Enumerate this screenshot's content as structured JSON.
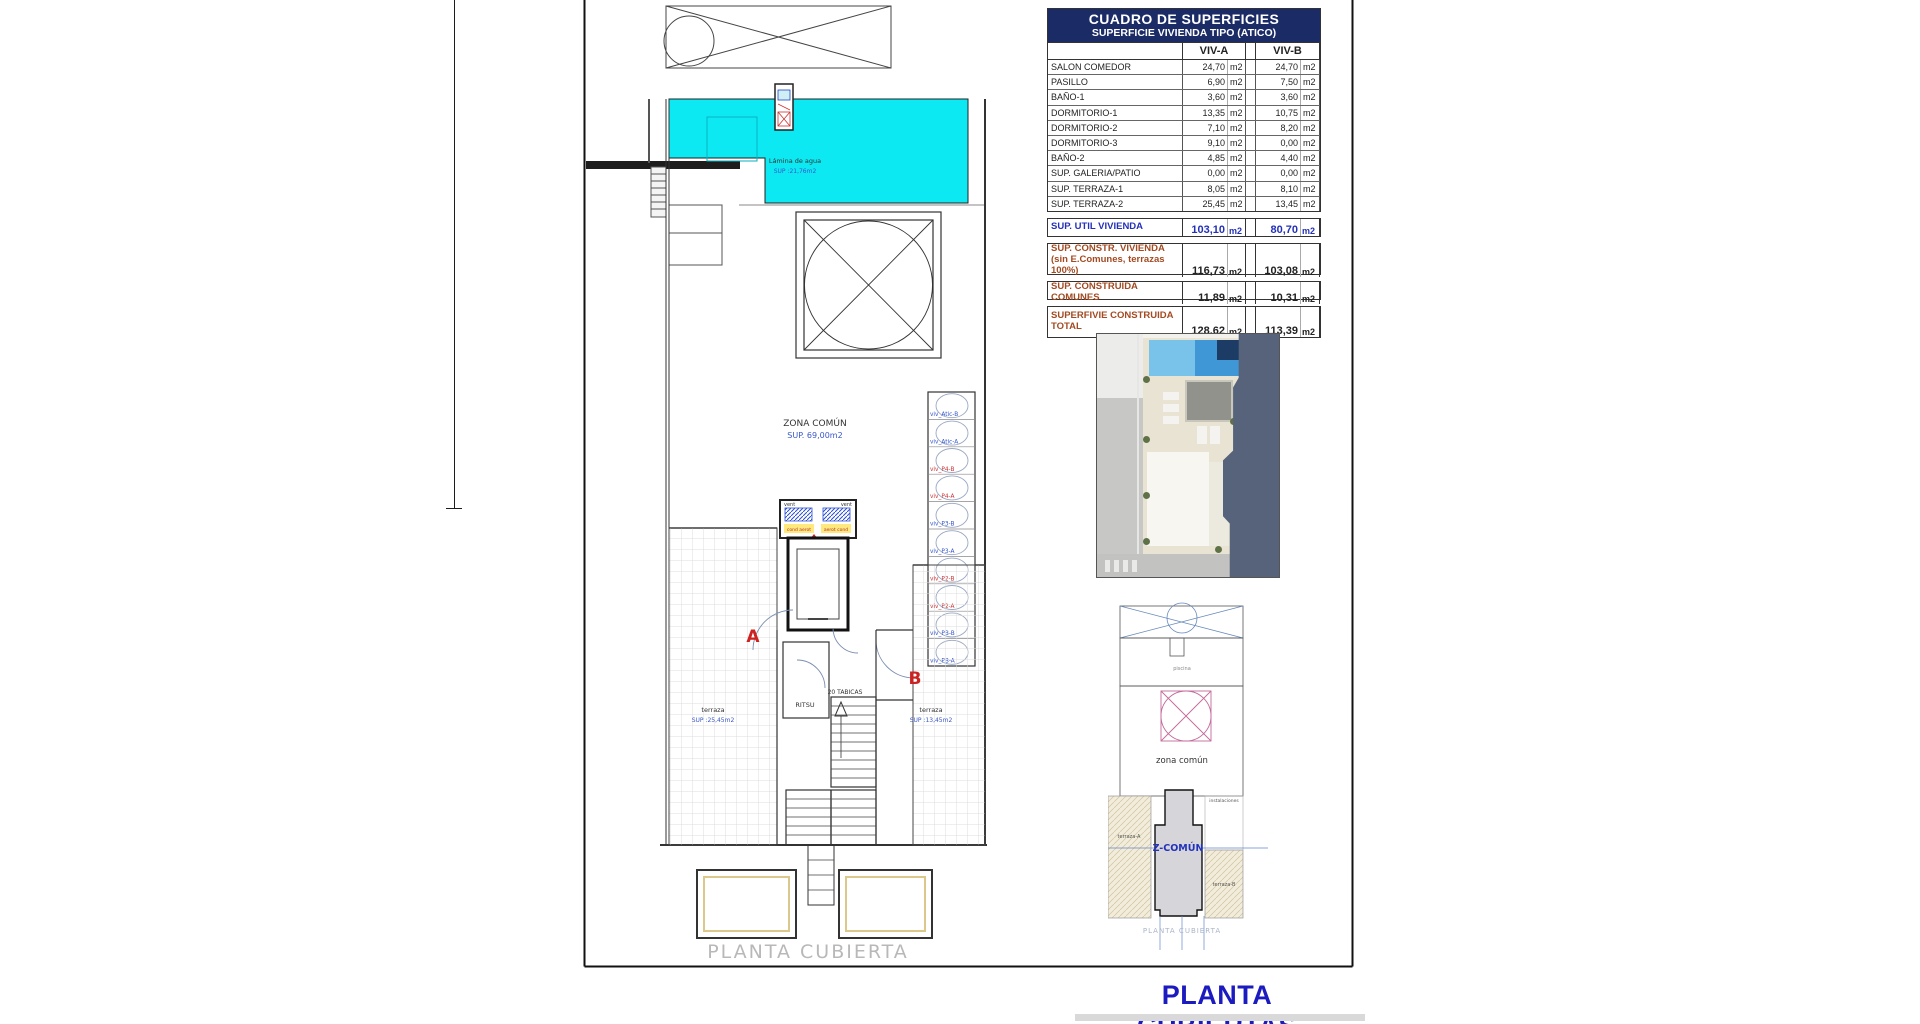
{
  "title": {
    "label": "PLANTA CUBIERTAS"
  },
  "plan": {
    "pool_label": "Lámina de agua",
    "pool_sup": "SUP :21,76m2",
    "zona_comun": "ZONA COMÚN",
    "zona_comun_sup": "SUP. 69,00m2",
    "terraza": "terraza",
    "terraza_a_sup": "SUP :25,45m2",
    "terraza_b_sup": "SUP :13,45m2",
    "letter_a": "A",
    "letter_b": "B",
    "tabicas": "20 TABICAS",
    "ritsu": "RITSU",
    "vent": "vent",
    "aerot_left": "cond aerot",
    "aerot_right": "aerot cond",
    "caption": "PLANTA CUBIERTA",
    "caption_clip": "0.00",
    "units": [
      {
        "label": "viv_Atic-B",
        "color": "#3355cc"
      },
      {
        "label": "viv_Atic-A",
        "color": "#3355cc"
      },
      {
        "label": "viv_P4-B",
        "color": "#cc3333"
      },
      {
        "label": "viv_P4-A",
        "color": "#cc3333"
      },
      {
        "label": "viv_P3-B",
        "color": "#3355cc"
      },
      {
        "label": "viv_P3-A",
        "color": "#3355cc"
      },
      {
        "label": "viv_P2-B",
        "color": "#cc3333"
      },
      {
        "label": "viv_P2-A",
        "color": "#cc3333"
      },
      {
        "label": "viv_PB-B",
        "color": "#3355cc"
      },
      {
        "label": "viv_PB-A",
        "color": "#3355cc"
      }
    ]
  },
  "table": {
    "title": "CUADRO DE SUPERFICIES",
    "subtitle": "SUPERFICIE VIVIENDA TIPO  (ATICO)",
    "col_a": "VIV-A",
    "col_b": "VIV-B",
    "unit": "m2",
    "rows": [
      {
        "name": "SALON COMEDOR",
        "a": "24,70",
        "b": "24,70"
      },
      {
        "name": "PASILLO",
        "a": "6,90",
        "b": "7,50"
      },
      {
        "name": "BAÑO-1",
        "a": "3,60",
        "b": "3,60"
      },
      {
        "name": "DORMITORIO-1",
        "a": "13,35",
        "b": "10,75"
      },
      {
        "name": "DORMITORIO-2",
        "a": "7,10",
        "b": "8,20"
      },
      {
        "name": "DORMITORIO-3",
        "a": "9,10",
        "b": "0,00"
      },
      {
        "name": "BAÑO-2",
        "a": "4,85",
        "b": "4,40"
      },
      {
        "name": "SUP. GALERIA/PATIO",
        "a": "0,00",
        "b": "0,00"
      },
      {
        "name": "SUP. TERRAZA-1",
        "a": "8,05",
        "b": "8,10"
      },
      {
        "name": "SUP. TERRAZA-2",
        "a": "25,45",
        "b": "13,45"
      }
    ],
    "summary": [
      {
        "name": "SUP. UTIL VIVIENDA",
        "name2": "",
        "a": "103,10",
        "b": "80,70"
      },
      {
        "name": "SUP. CONSTR. VIVIENDA",
        "name2": "(sin E.Comunes, terrazas 100%)",
        "a": "116,73",
        "b": "103,08"
      },
      {
        "name": "SUP. CONSTRUIDA COMUNES",
        "name2": "",
        "a": "11,89",
        "b": "10,31"
      },
      {
        "name": "SUPERFIVIE CONSTRUIDA",
        "name2": "TOTAL",
        "a": "128,62",
        "b": "113,39"
      }
    ],
    "colors": {
      "util": "#2330b8",
      "constr": "#a34a21",
      "header_bg": "#1a2b66"
    }
  },
  "site_plan": {
    "piscina": "piscina",
    "zona_comun": "zona común",
    "z_comun": "Z-COMÚN",
    "terraza_a": "terraza-A",
    "terraza_b": "terraza-B",
    "instalaciones": "instalaciones",
    "caption": "PLANTA CUBIERTA"
  }
}
